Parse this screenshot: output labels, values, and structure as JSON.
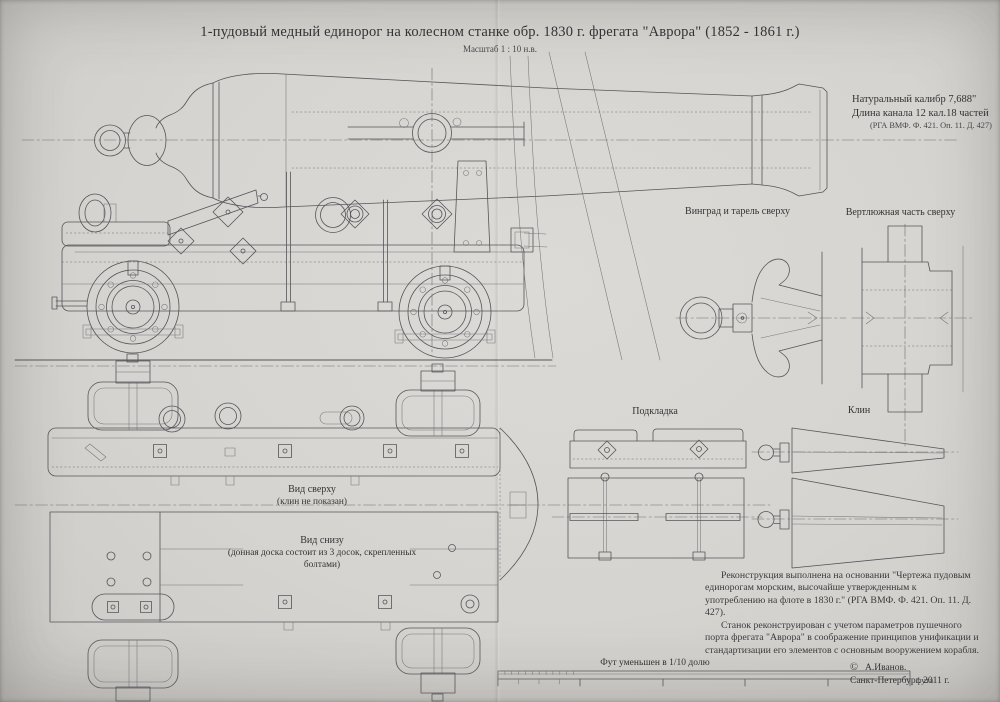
{
  "page": {
    "title": "1-пудовый медный единорог на колесном станке обр. 1830 г. фрегата \"Аврора\" (1852 - 1861 г.)",
    "scale_note": "Масштаб 1 : 10 н.в."
  },
  "specs": {
    "caliber": "Натуральный калибр 7,688\"",
    "bore_length": "Длина канала 12 кал.18 частей",
    "archive_ref": "(РГА ВМФ. Ф. 421. Оп. 11. Д. 427)"
  },
  "labels": {
    "cascabel_top": "Винград и тарель сверху",
    "trunnion_top": "Вертлюжная часть сверху",
    "pad": "Подкладка",
    "wedge": "Клин",
    "top_view": "Вид сверху",
    "top_view_note": "(клин не показан)",
    "bottom_view": "Вид снизу",
    "bottom_view_note": "(донная доска состоит из 3 досок, скрепленных болтами)",
    "foot_scale": "Фут уменьшен в 1/10 долю",
    "foot_unit": "фута"
  },
  "notes": {
    "para1": "Реконструкция выполнена на основании \"Чертежа пудовым единорогам морским, высочайше утвержденным к употреблению на флоте в 1830 г.\" (РГА ВМФ. Ф. 421. Оп. 11. Д. 427).",
    "para2": "Станок реконструирован с учетом параметров пушечного порта фрегата \"Аврора\" в соображение принципов унификации и стандартизации его элементов с основным вооружением корабля."
  },
  "credit": {
    "copyright_symbol": "©",
    "author": "А.Иванов.",
    "city_year": "Санкт-Петербург. 2011 г."
  },
  "colors": {
    "paper": "#d6d4d0",
    "line": "#55555a",
    "text": "#333335"
  }
}
